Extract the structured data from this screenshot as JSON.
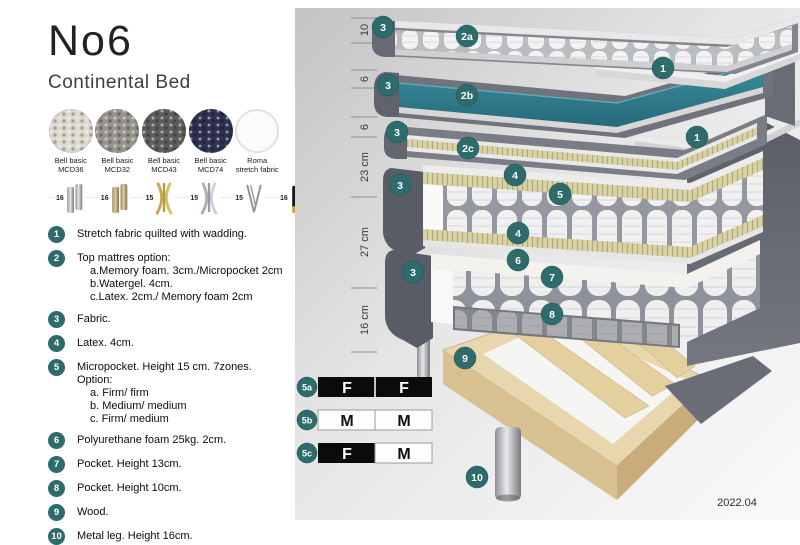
{
  "header": {
    "title": "No6",
    "subtitle": "Continental Bed"
  },
  "swatches": [
    {
      "line1": "Bell basic",
      "line2": "MCD36",
      "color": "#dcd9ce"
    },
    {
      "line1": "Bell basic",
      "line2": "MCD32",
      "color": "#96948c"
    },
    {
      "line1": "Bell basic",
      "line2": "MCD43",
      "color": "#5d5d5b"
    },
    {
      "line1": "Bell basic",
      "line2": "MCD74",
      "color": "#2e3150"
    },
    {
      "line1": "Roma",
      "line2": "stretch fabric",
      "color": "#fbfbfb"
    }
  ],
  "legs": [
    {
      "height": "16",
      "type": "cylinder-silver"
    },
    {
      "height": "16",
      "type": "cylinder-brass"
    },
    {
      "height": "15",
      "type": "cross-gold"
    },
    {
      "height": "15",
      "type": "cross-silver"
    },
    {
      "height": "15",
      "type": "hairpin"
    },
    {
      "height": "16",
      "type": "black-gold"
    }
  ],
  "features": [
    {
      "num": "1",
      "text": "Stretch fabric quilted with wadding."
    },
    {
      "num": "2",
      "text": "Top mattres option:",
      "subs": [
        "a.Memory foam. 3cm./Micropocket 2cm",
        "b.Watergel. 4cm.",
        "c.Latex. 2cm./ Memory foam 2cm"
      ]
    },
    {
      "num": "3",
      "text": "Fabric."
    },
    {
      "num": "4",
      "text": "Latex. 4cm."
    },
    {
      "num": "5",
      "text": "Micropocket. Height 15 cm. 7zones. Option:",
      "subs": [
        "a. Firm/ firm",
        "b. Medium/ medium",
        "c. Firm/ medium"
      ]
    },
    {
      "num": "6",
      "text": "Polyurethane foam 25kg. 2cm."
    },
    {
      "num": "7",
      "text": "Pocket. Height 13cm."
    },
    {
      "num": "8",
      "text": "Pocket. Height 10cm."
    },
    {
      "num": "9",
      "text": "Wood."
    },
    {
      "num": "10",
      "text": "Metal leg. Height 16cm."
    }
  ],
  "diagram": {
    "ruler_labels": [
      "10",
      "6",
      "6",
      "23 cm",
      "27 cm",
      "16 cm"
    ],
    "badges": [
      "3",
      "2a",
      "1",
      "3",
      "2b",
      "3",
      "2c",
      "1",
      "4",
      "5",
      "4",
      "3",
      "6",
      "7",
      "3",
      "8",
      "9",
      "10"
    ],
    "firmness": [
      {
        "id": "5a",
        "cells": [
          "F",
          "F"
        ]
      },
      {
        "id": "5b",
        "cells": [
          "M",
          "M"
        ]
      },
      {
        "id": "5c",
        "cells": [
          "F",
          "M"
        ]
      }
    ],
    "version": "2022.04"
  },
  "colors": {
    "badge_teal": "#2e6b6c",
    "watergel_teal": "#2f7f90",
    "fabric_gray": "#63666e",
    "latex_khaki": "#d9d2a4",
    "wood": "#e8d7ae",
    "firmness_dark": "#0b0b0b"
  }
}
